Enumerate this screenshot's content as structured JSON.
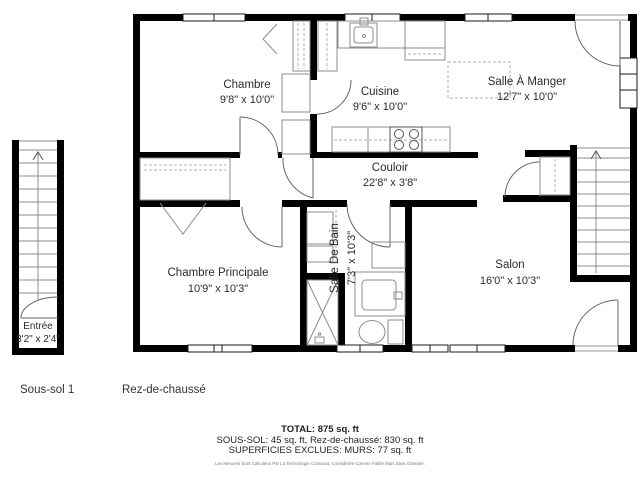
{
  "plan": {
    "rooms": [
      {
        "name": "Chambre",
        "dims": "9'8\" x 10'0\""
      },
      {
        "name": "Cuisine",
        "dims": "9'6\" x 10'0\""
      },
      {
        "name": "Salle À Manger",
        "dims": "12'7\" x 10'0\""
      },
      {
        "name": "Couloir",
        "dims": "22'8\" x 3'8\""
      },
      {
        "name": "Chambre Principale",
        "dims": "10'9\" x 10'3\""
      },
      {
        "name": "Salle De Bain",
        "dims": "7'3\" x 10'3\""
      },
      {
        "name": "Salon",
        "dims": "16'0\" x 10'3\""
      },
      {
        "name": "Entrée",
        "dims": "3'2\" x 2'4\""
      }
    ]
  },
  "floor_labels": [
    {
      "label": "Sous-sol 1"
    },
    {
      "label": "Rez-de-chaussé"
    }
  ],
  "summary": {
    "total": "TOTAL: 875 sq. ft",
    "breakdown": "SOUS-SOL: 45 sq. ft, Rez-de-chaussé: 830 sq. ft",
    "exclusions": "SUPERFICIES EXCLUES: MURS: 77 sq. ft",
    "disclaimer": "Les Mesures Sont Calculées Par La Technologie Cubicasa, Considérée Comme Fiable Mais Sans Garantie."
  },
  "colors": {
    "wall": "#000000",
    "fixture_line": "#8c8c8c",
    "door_arc": "#666666",
    "text": "#2b2b2b"
  }
}
